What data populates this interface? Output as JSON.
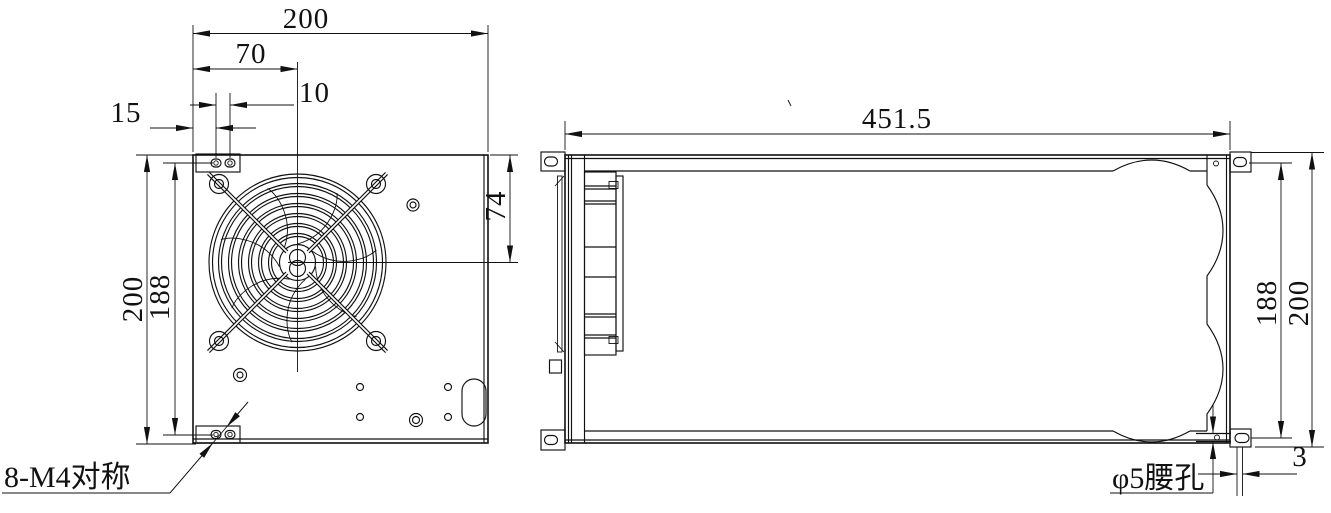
{
  "front_view": {
    "dim_width_total": "200",
    "dim_fan_center_x": "70",
    "dim_hole_pitch": "10",
    "dim_edge_to_hole": "15",
    "dim_height_total": "200",
    "dim_mount_span": "188",
    "dim_fan_center_y": "74",
    "mount_label": "8-M4对称"
  },
  "side_view": {
    "dim_length_total": "451.5",
    "dim_mount_span": "188",
    "dim_height_total": "200",
    "dim_slot_offset": "3",
    "slot_label": "φ5腰孔"
  },
  "colors": {
    "line": "#111111",
    "background": "#ffffff"
  }
}
